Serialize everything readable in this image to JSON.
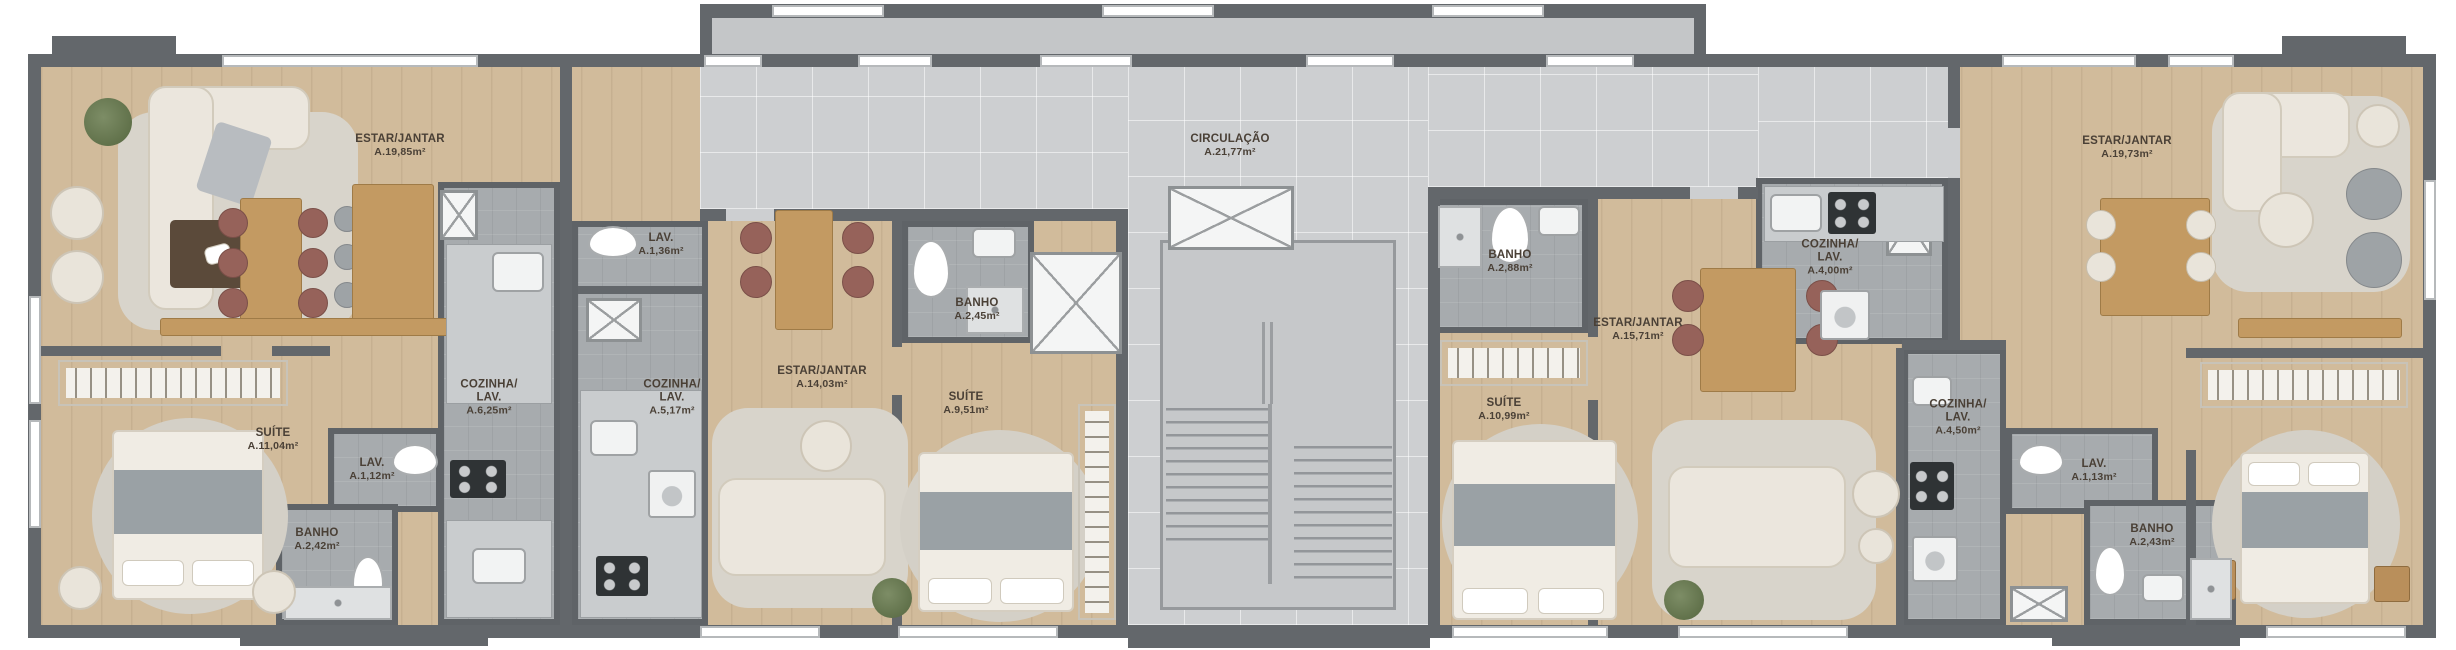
{
  "document": {
    "type": "architectural floor plan (pavement layout)",
    "language": "pt-BR"
  },
  "colors": {
    "wall": "#63676b",
    "wood_floor": "#d1bb9b",
    "wet_area_floor": "#a7abae",
    "circulation_floor": "#cdcfd1",
    "label_text": "#4a4036"
  },
  "circulation": {
    "name": "CIRCULAÇÃO",
    "area": "A.21,77m²"
  },
  "apartments": [
    {
      "id": "apartment-1",
      "rooms": {
        "estar": {
          "name": "ESTAR/JANTAR",
          "area": "A.19,85m²"
        },
        "suite": {
          "name": "SUÍTE",
          "area": "A.11,04m²"
        },
        "lav": {
          "name": "LAV.",
          "area": "A.1,12m²"
        },
        "banho": {
          "name": "BANHO",
          "area": "A.2,42m²"
        },
        "cozinha": {
          "name": "COZINHA/LAV.",
          "area": "A.6,25m²"
        }
      }
    },
    {
      "id": "apartment-2",
      "rooms": {
        "lav": {
          "name": "LAV.",
          "area": "A.1,36m²"
        },
        "cozinha": {
          "name": "COZINHA/LAV.",
          "area": "A.5,17m²"
        },
        "estar": {
          "name": "ESTAR/JANTAR",
          "area": "A.14,03m²"
        },
        "banho": {
          "name": "BANHO",
          "area": "A.2,45m²"
        },
        "suite": {
          "name": "SUÍTE",
          "area": "A.9,51m²"
        }
      }
    },
    {
      "id": "apartment-3",
      "rooms": {
        "banho": {
          "name": "BANHO",
          "area": "A.2,88m²"
        },
        "suite": {
          "name": "SUÍTE",
          "area": "A.10,99m²"
        },
        "estar": {
          "name": "ESTAR/JANTAR",
          "area": "A.15,71m²"
        },
        "cozinha": {
          "name": "COZINHA/LAV.",
          "area": "A.4,00m²"
        }
      }
    },
    {
      "id": "apartment-4",
      "rooms": {
        "estar": {
          "name": "ESTAR/JANTAR",
          "area": "A.19,73m²"
        },
        "cozinha": {
          "name": "COZINHA/LAV.",
          "area": "A.4,50m²"
        },
        "lav": {
          "name": "LAV.",
          "area": "A.1,13m²"
        },
        "banho": {
          "name": "BANHO",
          "area": "A.2,43m²"
        }
      }
    }
  ]
}
